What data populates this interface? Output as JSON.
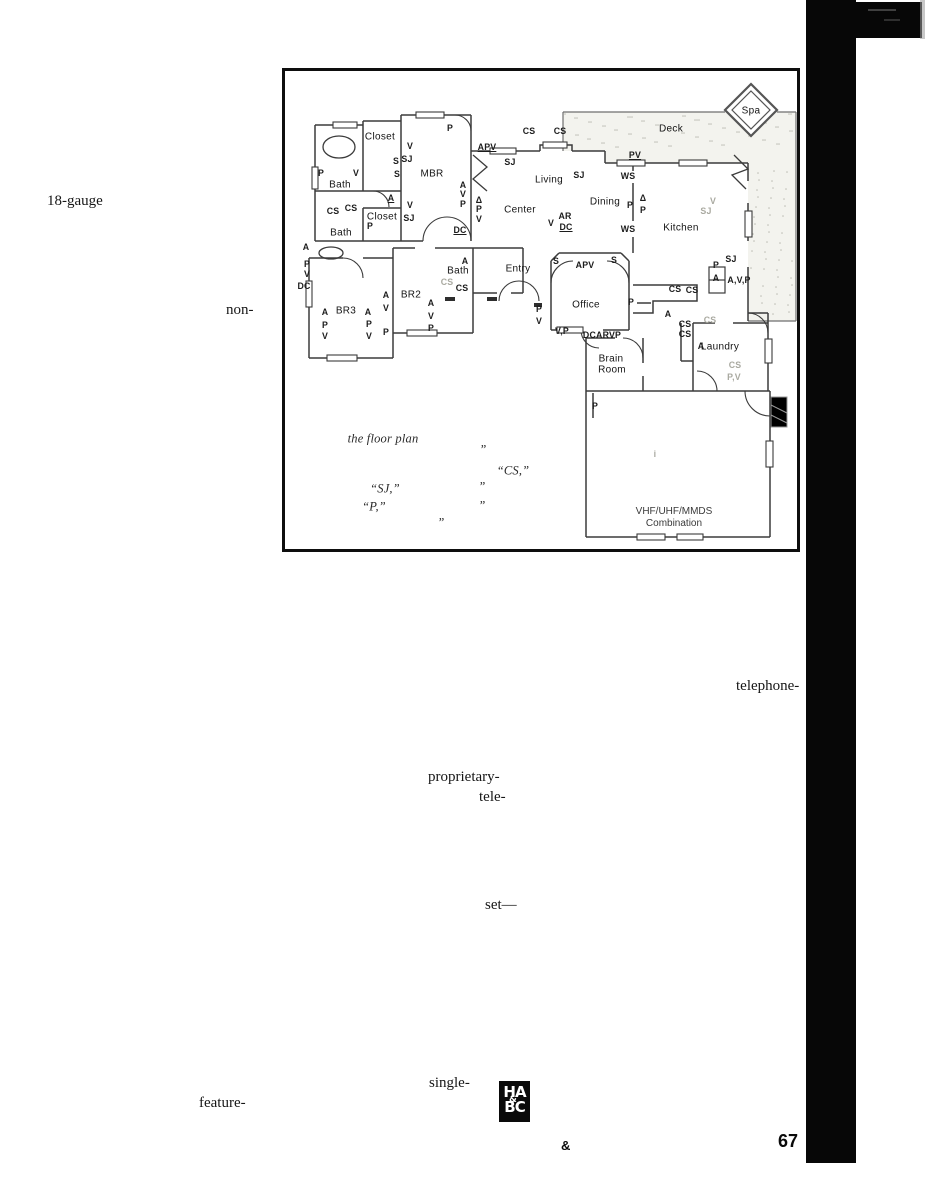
{
  "page": {
    "text_fragments": [
      {
        "text": "18-gauge",
        "x": 47,
        "y": 193
      },
      {
        "text": "non-",
        "x": 226,
        "y": 302
      },
      {
        "text": "telephone-",
        "x": 736,
        "y": 678
      },
      {
        "text": "proprietary-",
        "x": 428,
        "y": 769
      },
      {
        "text": "tele-",
        "x": 479,
        "y": 789
      },
      {
        "text": "set—",
        "x": 485,
        "y": 897
      },
      {
        "text": "single-",
        "x": 429,
        "y": 1075
      },
      {
        "text": "feature-",
        "x": 199,
        "y": 1095
      }
    ],
    "footer": {
      "ampersand": "&",
      "page_number": "67"
    },
    "logo": {
      "top": "HA",
      "mid": "&",
      "bottom": "BC"
    }
  },
  "floorplan": {
    "rooms": [
      {
        "text": "Closet",
        "x": 95,
        "y": 66
      },
      {
        "text": "MBR",
        "x": 147,
        "y": 103
      },
      {
        "text": "Bath",
        "x": 55,
        "y": 114
      },
      {
        "text": "Closet",
        "x": 97,
        "y": 146
      },
      {
        "text": "Bath",
        "x": 56,
        "y": 162
      },
      {
        "text": "BR3",
        "x": 61,
        "y": 240
      },
      {
        "text": "BR2",
        "x": 126,
        "y": 224
      },
      {
        "text": "Bath",
        "x": 173,
        "y": 200
      },
      {
        "text": "Entry",
        "x": 233,
        "y": 198
      },
      {
        "text": "Living",
        "x": 264,
        "y": 109
      },
      {
        "text": "Center",
        "x": 235,
        "y": 139
      },
      {
        "text": "Dining",
        "x": 320,
        "y": 131
      },
      {
        "text": "Kitchen",
        "x": 396,
        "y": 157
      },
      {
        "text": "Office",
        "x": 301,
        "y": 234
      },
      {
        "text": "Brain",
        "x": 326,
        "y": 288
      },
      {
        "text": "Room",
        "x": 327,
        "y": 299
      },
      {
        "text": "Laundry",
        "x": 435,
        "y": 276
      },
      {
        "text": "Deck",
        "x": 386,
        "y": 58
      },
      {
        "text": "Spa",
        "x": 466,
        "y": 40
      }
    ],
    "codes": [
      {
        "text": "P",
        "x": 165,
        "y": 57
      },
      {
        "text": "CS",
        "x": 244,
        "y": 60
      },
      {
        "text": "CS",
        "x": 275,
        "y": 60
      },
      {
        "text": "APV",
        "x": 202,
        "y": 76,
        "cls": "u"
      },
      {
        "text": "SJ",
        "x": 225,
        "y": 91
      },
      {
        "text": "SJ",
        "x": 294,
        "y": 104
      },
      {
        "text": "PV",
        "x": 350,
        "y": 84,
        "cls": "u"
      },
      {
        "text": "WS",
        "x": 343,
        "y": 105
      },
      {
        "text": "P",
        "x": 345,
        "y": 134
      },
      {
        "text": "Δ",
        "x": 358,
        "y": 127
      },
      {
        "text": "P",
        "x": 358,
        "y": 139
      },
      {
        "text": "V",
        "x": 428,
        "y": 130,
        "cls": "f"
      },
      {
        "text": "SJ",
        "x": 421,
        "y": 140,
        "cls": "f"
      },
      {
        "text": "V",
        "x": 125,
        "y": 75
      },
      {
        "text": "SJ",
        "x": 122,
        "y": 88
      },
      {
        "text": "S",
        "x": 111,
        "y": 90
      },
      {
        "text": "S",
        "x": 112,
        "y": 103
      },
      {
        "text": "P",
        "x": 36,
        "y": 102
      },
      {
        "text": "V",
        "x": 71,
        "y": 102
      },
      {
        "text": "CS",
        "x": 48,
        "y": 140
      },
      {
        "text": "CS",
        "x": 66,
        "y": 137
      },
      {
        "text": "A",
        "x": 106,
        "y": 127,
        "cls": "u"
      },
      {
        "text": "P",
        "x": 85,
        "y": 155
      },
      {
        "text": "V",
        "x": 125,
        "y": 134
      },
      {
        "text": "SJ",
        "x": 124,
        "y": 147
      },
      {
        "text": "A",
        "x": 178,
        "y": 114
      },
      {
        "text": "V",
        "x": 178,
        "y": 123
      },
      {
        "text": "P",
        "x": 178,
        "y": 133
      },
      {
        "text": "Δ",
        "x": 194,
        "y": 129
      },
      {
        "text": "P",
        "x": 194,
        "y": 138
      },
      {
        "text": "V",
        "x": 194,
        "y": 148
      },
      {
        "text": "DC",
        "x": 175,
        "y": 159,
        "cls": "u"
      },
      {
        "text": "V",
        "x": 266,
        "y": 152
      },
      {
        "text": "AR",
        "x": 280,
        "y": 145
      },
      {
        "text": "DC",
        "x": 281,
        "y": 156,
        "cls": "u"
      },
      {
        "text": "WS",
        "x": 343,
        "y": 158
      },
      {
        "text": "A",
        "x": 21,
        "y": 176
      },
      {
        "text": "P",
        "x": 22,
        "y": 193
      },
      {
        "text": "V",
        "x": 22,
        "y": 203
      },
      {
        "text": "DC",
        "x": 19,
        "y": 215
      },
      {
        "text": "A",
        "x": 40,
        "y": 241
      },
      {
        "text": "A",
        "x": 83,
        "y": 241
      },
      {
        "text": "P",
        "x": 40,
        "y": 254
      },
      {
        "text": "V",
        "x": 40,
        "y": 265
      },
      {
        "text": "P",
        "x": 84,
        "y": 253
      },
      {
        "text": "V",
        "x": 84,
        "y": 265
      },
      {
        "text": "A",
        "x": 101,
        "y": 224
      },
      {
        "text": "V",
        "x": 101,
        "y": 237
      },
      {
        "text": "P",
        "x": 101,
        "y": 261
      },
      {
        "text": "A",
        "x": 146,
        "y": 232
      },
      {
        "text": "V",
        "x": 146,
        "y": 245
      },
      {
        "text": "P",
        "x": 146,
        "y": 257
      },
      {
        "text": "A",
        "x": 180,
        "y": 190
      },
      {
        "text": "CS",
        "x": 162,
        "y": 211,
        "cls": "f"
      },
      {
        "text": "CS",
        "x": 177,
        "y": 217
      },
      {
        "text": "P",
        "x": 254,
        "y": 238
      },
      {
        "text": "V",
        "x": 254,
        "y": 250
      },
      {
        "text": "S",
        "x": 271,
        "y": 190
      },
      {
        "text": "APV",
        "x": 300,
        "y": 194
      },
      {
        "text": "S",
        "x": 329,
        "y": 189
      },
      {
        "text": "P",
        "x": 346,
        "y": 231
      },
      {
        "text": "V,P",
        "x": 277,
        "y": 260
      },
      {
        "text": "DCARVP",
        "x": 317,
        "y": 264
      },
      {
        "text": "P",
        "x": 310,
        "y": 335
      },
      {
        "text": "P",
        "x": 431,
        "y": 194
      },
      {
        "text": "SJ",
        "x": 446,
        "y": 188
      },
      {
        "text": "A",
        "x": 431,
        "y": 207
      },
      {
        "text": "A,V,P",
        "x": 454,
        "y": 209
      },
      {
        "text": "CS",
        "x": 390,
        "y": 218
      },
      {
        "text": "CS",
        "x": 407,
        "y": 219
      },
      {
        "text": "A",
        "x": 383,
        "y": 243
      },
      {
        "text": "CS",
        "x": 400,
        "y": 253
      },
      {
        "text": "CS",
        "x": 400,
        "y": 263
      },
      {
        "text": "A",
        "x": 416,
        "y": 275
      },
      {
        "text": "CS",
        "x": 425,
        "y": 249,
        "cls": "f"
      },
      {
        "text": "CS",
        "x": 450,
        "y": 294,
        "cls": "f"
      },
      {
        "text": "P,V",
        "x": 449,
        "y": 306,
        "cls": "f"
      }
    ],
    "caption": [
      {
        "text": "the floor plan",
        "x": 98,
        "y": 368,
        "cls": "cap"
      },
      {
        "text": "”",
        "x": 198,
        "y": 379,
        "cls": "cap"
      },
      {
        "text": "“CS,”",
        "x": 228,
        "y": 400,
        "cls": "cap"
      },
      {
        "text": "“SJ,”",
        "x": 100,
        "y": 418,
        "cls": "cap"
      },
      {
        "text": "”",
        "x": 197,
        "y": 416,
        "cls": "cap"
      },
      {
        "text": "“P,”",
        "x": 89,
        "y": 436,
        "cls": "cap"
      },
      {
        "text": "”",
        "x": 197,
        "y": 435,
        "cls": "cap"
      },
      {
        "text": "”",
        "x": 156,
        "y": 452,
        "cls": "cap"
      },
      {
        "text": "i",
        "x": 370,
        "y": 383,
        "cls": "f"
      }
    ],
    "antenna": {
      "line1": "VHF/UHF/MMDS",
      "line2": "Combination"
    }
  }
}
